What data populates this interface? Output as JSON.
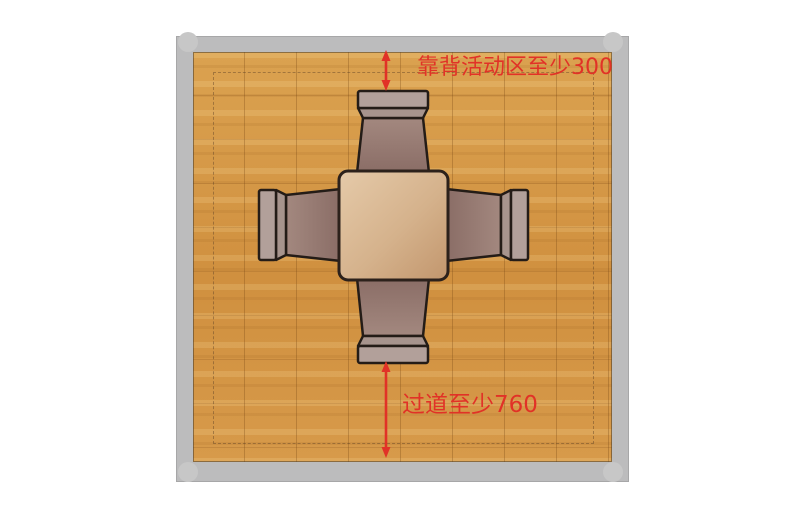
{
  "figure": {
    "type": "interior-layout-diagram",
    "subject": "top view of square dining table with four chairs and clearance dimensions"
  },
  "annotations": {
    "backrest_zone": {
      "text": "靠背活动区至少300",
      "value": 300
    },
    "aisle": {
      "text": "过道至少760",
      "value": 760
    }
  },
  "colors": {
    "accent-red": "#e13227",
    "wall-gray": "#bcbcbd",
    "wall-edge": "#a7a7a8",
    "corner-gray": "#c7c7c7",
    "outline-dark": "#241c17",
    "table-border": "#2c211b",
    "chair-bar": "#b2a09a",
    "chair-bevel": "#a7948d",
    "chair-seat-light": "#a3887f",
    "chair-seat-dark": "#8a6d66",
    "table-light": "#e5caa9",
    "table-mid": "#d5b28c",
    "table-dark": "#c2966d"
  }
}
